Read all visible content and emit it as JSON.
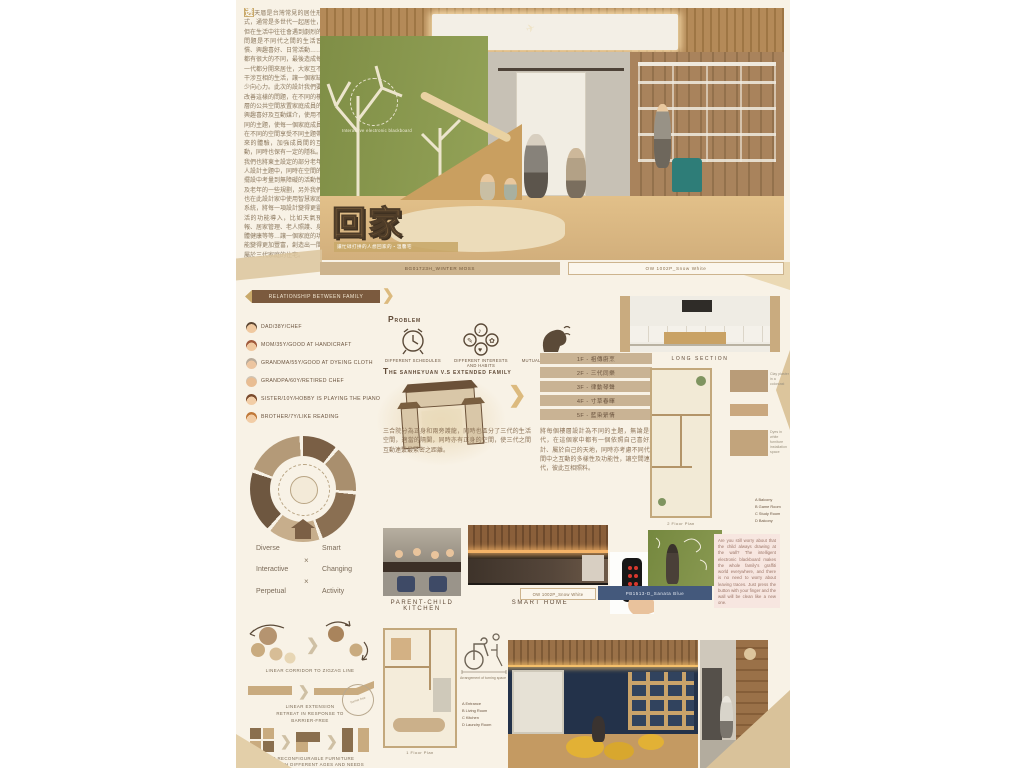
{
  "intro": {
    "highlight": "透",
    "text": "天厝是台灣常見的居住形式，通常是多世代一起居住，但在生活中往往會遇到劇烈的問題是不同代之間的生活習慣、興趣喜好、日常活動……都有很大的不同，最後造成每一代都分開來居住，大家互不干涉互相的生活，讓一個家缺少向心力。此次的設計我們要改善這樣的問題，在不同的樓層的公共空間放置家庭成員的興趣喜好及互動媒介，使用不同的主題，使每一個家庭成員在不同的空間享受不同主題帶來的體驗，加強成員間的互動，同時也保有一定的隱私。我們也將東主設定的部分老年人設計主題中，同時在空間的擺設中考量到無障礙的活動性及老年的一些規劃，另外我們也在此設計家中使用智慧家庭系統，將每一項設計變得更靈活的功能導入，比如天氣預報、居家管理、老人照護、身體健康等等…讓一個家庭的功能變得更加豐富，創造出一間屬於三代家庭的住宅。"
  },
  "hero": {
    "board_label": "Interactive electronic blackboard",
    "title": "回家",
    "subtitle": "讓忙碌打拼的人想回家的・溫馨宅",
    "plane_icon": "✈"
  },
  "bars": {
    "winter_moss": "BG01723H_WINTER MOSS",
    "snow_white": "OW 1002P_Snow White",
    "snow_white2": "OW 1002P_Snow White",
    "sanata_blue": "PB1513-D_Sanata Blue"
  },
  "family": {
    "heading": "Relationship between family",
    "chevron": "❯",
    "members": [
      "DAD/38Y/CHEF",
      "MOM/35Y/GOOD AT HANDICRAFT",
      "GRANDMA/55Y/GOOD AT DYEING CLOTH",
      "GRANDPA/60Y/RETIRED CHEF",
      "SISTER/10Y/HOBBY IS PLAYING THE PIANO",
      "BROTHER/7Y/LIKE READING"
    ]
  },
  "concept": {
    "left": [
      "Diverse",
      "Interactive",
      "Perpetual"
    ],
    "right": [
      "Smart",
      "Changing",
      "Activity"
    ],
    "x": "×"
  },
  "strategies": {
    "s1": "Linear corridor to zigzag line",
    "s2a": "Linear extension",
    "s2b": "Retreat in response to",
    "s2c": "Barrier-free",
    "s3a": "Use reconfigurable furniture",
    "s3b": "Varies with different ages and needs",
    "stamp": "barrier free",
    "chevron": "❯"
  },
  "problem": {
    "heading": "Problem",
    "label1": "Different schedules",
    "label2": "Different interests and habits",
    "label3": "Mutual interference"
  },
  "sanheyuan": {
    "heading": "The Sanheyuan v.s extended family",
    "chevron": "❯",
    "floors": [
      "1F - 祖傳廚烹",
      "2F - 三代同樂",
      "3F - 律動琴聲",
      "4F - 寸草春暉",
      "5F - 藍染縈情"
    ],
    "para_left": "三合院分為正身和兩旁護龍，同時也區分了三代的生活空間，適當的隔閡，同時亦有正身的空間，使三代之間互動連繫最緊密之距離。",
    "para_right": "將每個樓層設計為不同的主題，無論是哪一代，在這個家中都有一個依照自己喜好所設計、屬於自己的天地，同時亦考慮不同代在空間中之互動的多樣性及功能性，讓空間連結三代，彼此互相照料。"
  },
  "captions": {
    "long_section": "Long Section",
    "kitchen": "Parent-child Kitchen",
    "smart": "Smart Home",
    "plan1": "1 Floor Plan",
    "plan2": "2 Floor Plan",
    "wheelchair": "Arrangement of turning space"
  },
  "note": {
    "text": "Are you still worry about that the child always drawing at the wall? The intelligent electronic blackboard makes the whole family's graffiti world everywhere, and there is no need to worry about leaving traces. Just press the button with your finger and the wall will be clean like a new one."
  },
  "legends": {
    "plan2": [
      "A Balcony",
      "B Game Room",
      "C Study Room",
      "D Balcony"
    ],
    "plan1": [
      "A Entrance",
      "B Living Room",
      "C Kitchen",
      "D Laundry Room"
    ]
  },
  "materials": {
    "m1": "Clay plaster in a colorcast",
    "m2": "Dyes in white furniture installation space"
  },
  "colors": {
    "green_wall": "#87964e",
    "tan": "#c9b28c",
    "brown": "#6b4f38",
    "navy": "#44597c",
    "beanbag_yellow": "#e2b135",
    "play_wall_blue": "#23324a"
  }
}
